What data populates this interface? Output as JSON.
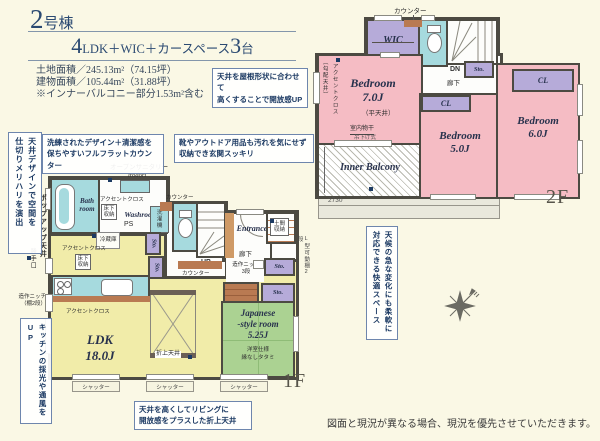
{
  "colors": {
    "background": "#faf8e5",
    "bedroom_pink": "#f5bcc4",
    "closet_purple": "#b6abd9",
    "water_cyan": "#a6dade",
    "ldk_yellow": "#f1eca9",
    "tatami_green": "#abd292",
    "wall": "#4c4a42",
    "callout_navy": "#1c3a63",
    "counter_brown": "#b97a52"
  },
  "header": {
    "num": "2",
    "unit": "号棟",
    "n1": "4",
    "mid": "LDK＋WIC＋カースペース",
    "n2": "3",
    "tail": "台",
    "land": "土地面積／245.13m²（74.15坪）",
    "bldg": "建物面積／105.44m²（31.88坪）",
    "note": "※インナーバルコニー部分1.53m²含む"
  },
  "callouts": {
    "roof": "天井を屋根形状に合わせて\n高くすることで開放感UP",
    "counter": "洗練されたデザイン＋清潔感を\n保ちやすいフルフラットカウンター",
    "shoes": "靴やアウトドア用品も汚れを気にせず\n収納でき玄関スッキリ",
    "zoning": "天井デザインで空間を\n仕切りメリハリを演出",
    "vent": "キッチンの採光や通風をUP",
    "weather": "天候の急な変化にも柔軟に\n対応できる快適スペース",
    "oriage": "天井を高くしてリビングに\n開放感をプラスした折上天井"
  },
  "f2": {
    "floor": "2F",
    "counter": "カウンター",
    "wic": "WIC",
    "dn": "DN",
    "sto": "Sto.",
    "hall": "廊下",
    "cl": "CL",
    "bed7": "Bedroom\n7.0J",
    "bed5": "Bedroom\n5.0J",
    "bed6": "Bedroom\n6.0J",
    "slope": "（勾配天井）",
    "flat": "（平天井）",
    "accent": "アクセントクロス",
    "drying": "室内物干",
    "drying2": "吊下げ式",
    "balcony": "Inner Balcony",
    "dim": "2730"
  },
  "f1": {
    "floor": "1F",
    "opensan": "オープンサニタリー",
    "irodori": "irodori",
    "bath": "Bath\nroom",
    "accent": "アクセントクロス",
    "uf": "床下\n収納",
    "washroom": "Washroom",
    "ps": "PS",
    "washer": "洗濯機",
    "counter": "カウンター",
    "up": "UP",
    "entrance": "Entrance",
    "doma": "土間\n収納",
    "hall": "廊下",
    "niche3": "造作ニッチ\n3段",
    "shelf": "L型可動棚2段",
    "sto": "Sto.",
    "fridge": "冷蔵庫",
    "niche2": "造作ニッチ\n（棚2段）",
    "backdoor": "勝手口",
    "popup": "ポップアップ天井",
    "ldk": "LDK\n18.0J",
    "oriage": "折上天井",
    "jroom": "Japanese\n-style room\n5.25J",
    "jsub": "洋室仕様\n縁なしタタミ",
    "shutter": "シャッター"
  },
  "disclaimer": "図面と現況が異なる場合、現況を優先させていただきます。"
}
